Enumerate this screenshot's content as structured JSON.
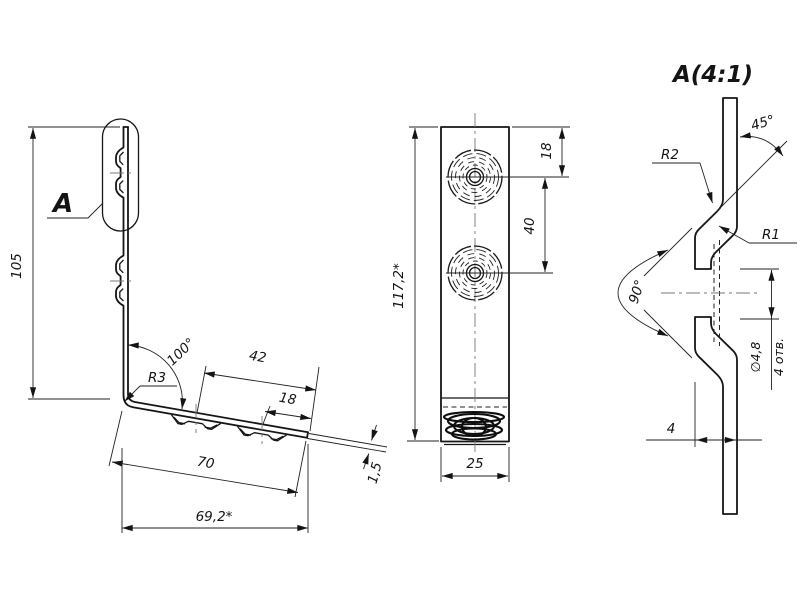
{
  "drawing": {
    "callout_label": "A",
    "detail_title": "A(4:1)",
    "side_view": {
      "height": "105",
      "bend_angle": "100°",
      "bend_radius": "R3",
      "dim_42": "42",
      "dim_18": "18",
      "dim_70": "70",
      "dim_69_2": "69,2*",
      "thickness": "1,5"
    },
    "front_view": {
      "flat_length": "117,2*",
      "hole_edge_offset": "18",
      "hole_spacing": "40",
      "width": "25"
    },
    "detail_view": {
      "chamfer_angle": "45°",
      "outer_radius": "R2",
      "inner_radius": "R1",
      "cone_angle": "90°",
      "hole_diameter": "∅4,8",
      "hole_count": "4 отв.",
      "dimple_height": "4"
    }
  }
}
